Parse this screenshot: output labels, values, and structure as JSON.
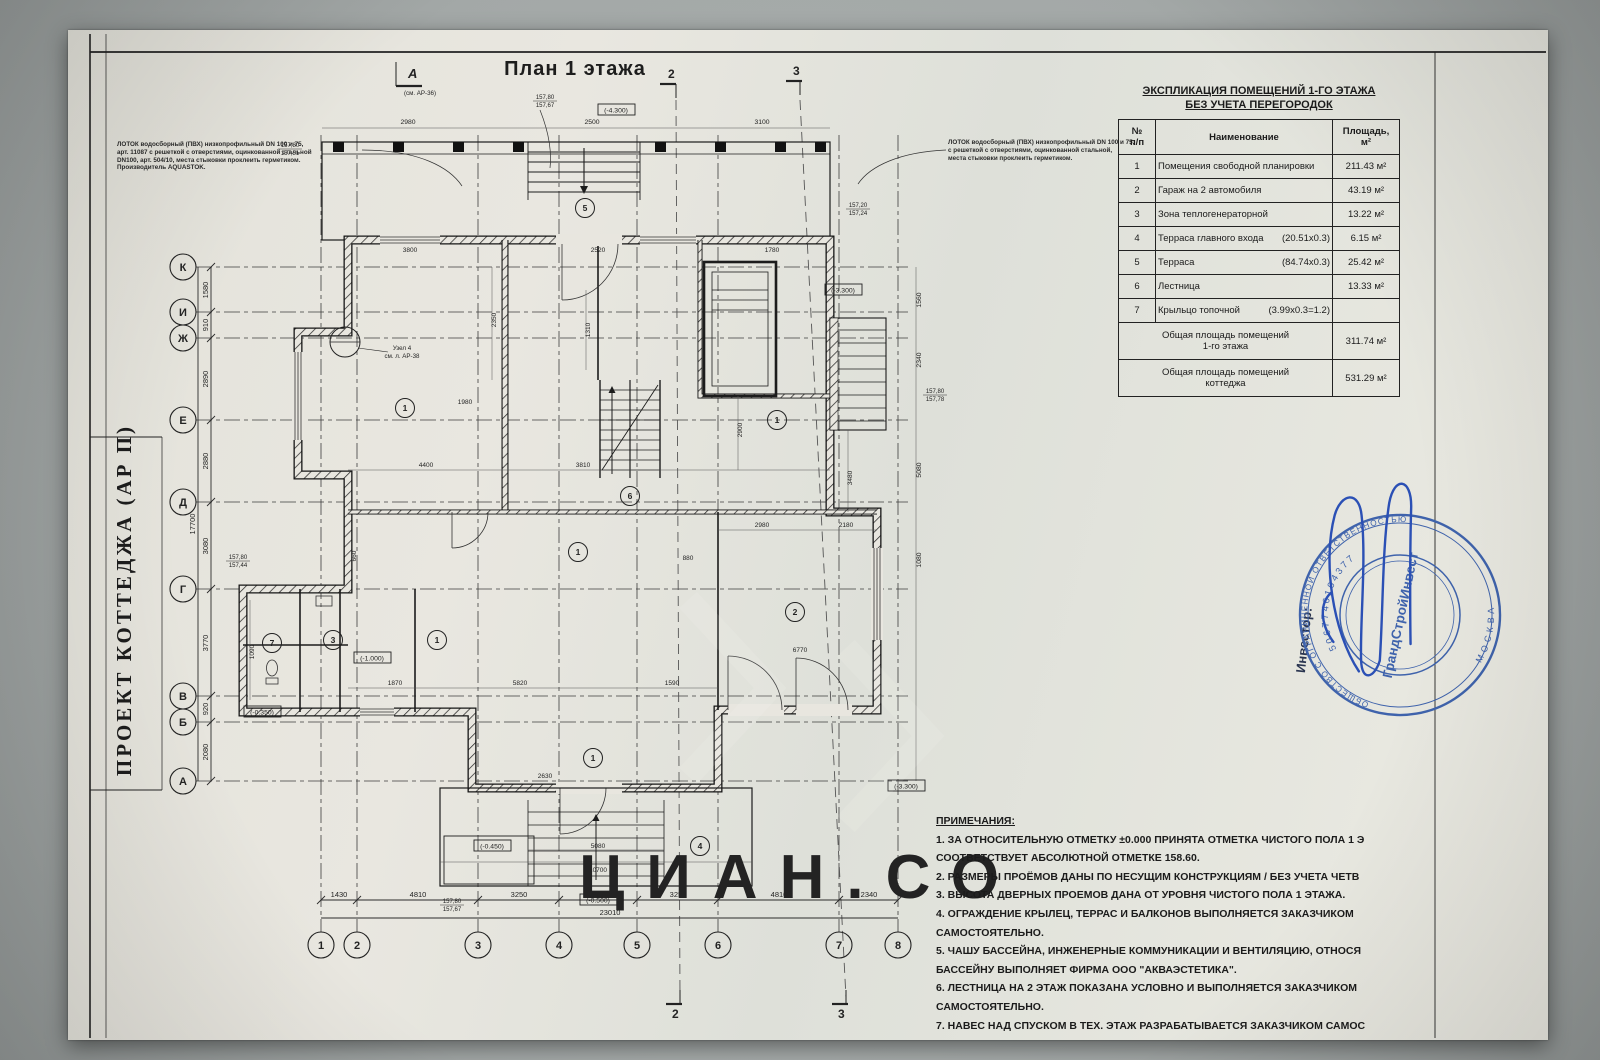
{
  "titles": {
    "plan_title": "План 1 этажа",
    "side_title": "ПРОЕКТ КОТТЕДЖА (АР П)"
  },
  "photo": {
    "watermark": "ЦИАН.СО"
  },
  "frame_markers": {
    "view_a": "А",
    "view_a_ref": "(см. АР-36)",
    "sec2": "2",
    "sec3": "3",
    "sec2b": "2",
    "sec3b": "3"
  },
  "lotok_left": [
    "ЛОТОК водосборный (ПВХ) низкопрофильный DN 100 и 75,",
    "арт. 11087 с решеткой с отверстиями, оцинкованной стальной",
    "DN100, арт. 504/10, места стыковки проклеить герметиком.",
    "Производитель AQUASTOK."
  ],
  "lotok_right": [
    "ЛОТОК водосборный (ПВХ) низкопрофильный DN 100 и 75,",
    "с решеткой с отверстиями, оцинкованной стальной,",
    "места стыковки проклеить герметиком."
  ],
  "explication": {
    "title_line1": "ЭКСПЛИКАЦИЯ ПОМЕЩЕНИЙ 1-ГО ЭТАЖА",
    "title_line2": "БЕЗ УЧЕТА ПЕРЕГОРОДОК",
    "col_num": "№\nп/п",
    "col_name": "Наименование",
    "col_area": "Площадь,\nм²",
    "rows": [
      {
        "num": "1",
        "name": "Помещения свободной планировки",
        "dims": "",
        "area": "211.43 м²"
      },
      {
        "num": "2",
        "name": "Гараж на 2 автомобиля",
        "dims": "",
        "area": "43.19 м²"
      },
      {
        "num": "3",
        "name": "Зона теплогенераторной",
        "dims": "",
        "area": "13.22 м²"
      },
      {
        "num": "4",
        "name": "Терраса главного входа",
        "dims": "(20.51х0.3)",
        "area": "6.15 м²"
      },
      {
        "num": "5",
        "name": "Терраса",
        "dims": "(84.74х0.3)",
        "area": "25.42 м²"
      },
      {
        "num": "6",
        "name": "Лестница",
        "dims": "",
        "area": "13.33 м²"
      },
      {
        "num": "7",
        "name": "Крыльцо топочной",
        "dims": "(3.99х0.3=1.2)",
        "area": ""
      }
    ],
    "total1_name": "Общая площадь помещений\n1-го этажа",
    "total1_area": "311.74 м²",
    "total2_name": "Общая площадь помещений\nкоттеджа",
    "total2_area": "531.29 м²"
  },
  "notes": {
    "heading": "ПРИМЕЧАНИЯ:",
    "lines": [
      "1. ЗА ОТНОСИТЕЛЬНУЮ ОТМЕТКУ ±0.000 ПРИНЯТА ОТМЕТКА ЧИСТОГО ПОЛА 1 Э",
      "СООТВЕТСТВУЕТ АБСОЛЮТНОЙ ОТМЕТКЕ 158.60.",
      "2. РАЗМЕРЫ ПРОЁМОВ ДАНЫ ПО НЕСУЩИМ КОНСТРУКЦИЯМ / БЕЗ УЧЕТА ЧЕТВ",
      "3. ВЫСОТА ДВЕРНЫХ ПРОЕМОВ ДАНА ОТ УРОВНЯ ЧИСТОГО ПОЛА 1 ЭТАЖА.",
      "4. ОГРАЖДЕНИЕ КРЫЛЕЦ, ТЕРРАС И БАЛКОНОВ ВЫПОЛНЯЕТСЯ ЗАКАЗЧИКОМ",
      "САМОСТОЯТЕЛЬНО.",
      "5. ЧАШУ БАССЕЙНА, ИНЖЕНЕРНЫЕ КОММУНИКАЦИИ И ВЕНТИЛЯЦИЮ, ОТНОСЯ",
      "БАССЕЙНУ ВЫПОЛНЯЕТ ФИРМА ООО \"АКВАЭСТЕТИКА\".",
      "6. ЛЕСТНИЦА НА 2 ЭТАЖ ПОКАЗАНА УСЛОВНО И ВЫПОЛНЯЕТСЯ ЗАКАЗЧИКОМ",
      "САМОСТОЯТЕЛЬНО.",
      "7. НАВЕС НАД СПУСКОМ В ТЕХ. ЭТАЖ РАЗРАБАТЫВАЕТСЯ ЗАКАЗЧИКОМ САМОС"
    ]
  },
  "plan": {
    "axes_left": [
      "К",
      "И",
      "Ж",
      "Е",
      "Д",
      "Г",
      "В",
      "Б",
      "А"
    ],
    "axes_bottom": [
      "1",
      "2",
      "3",
      "4",
      "5",
      "6",
      "7",
      "8"
    ],
    "dims_left": [
      "1580",
      "910",
      "2890",
      "2880",
      "3080",
      "3770",
      "920",
      "2080"
    ],
    "dims_left_total": "17700",
    "dims_bottom": [
      "1430",
      "4810",
      "3250",
      "3120",
      "3250",
      "4810",
      "2340"
    ],
    "dims_bottom_total": "23010",
    "dims_top": [
      "2980",
      "2500",
      "3100"
    ],
    "dims_right": [
      "1560",
      "2340",
      "5080",
      "1080"
    ],
    "dims_small": [
      "3800",
      "2520",
      "1780",
      "4400",
      "3810",
      "2980",
      "2180",
      "5820",
      "1870",
      "1590",
      "2630",
      "6770",
      "3480",
      "2350",
      "1090",
      "5080",
      "10700",
      "660",
      "1980",
      "2900",
      "1310",
      "880"
    ],
    "rooms": [
      "1",
      "5",
      "6",
      "1",
      "1",
      "2",
      "3",
      "7",
      "1",
      "1",
      "4"
    ],
    "levels": [
      "(-4.300)",
      "(-3.300)",
      "(-1.000)",
      "(-0.350)",
      "(-0.450)",
      "(-0.500)",
      "(-3.300)"
    ],
    "elev": [
      "157,80",
      "157,51",
      "157,80",
      "157,67",
      "157,20",
      "157,24",
      "157,80",
      "157,44",
      "157,80",
      "157,78",
      "157,80",
      "157,67"
    ],
    "detail_label1": "Узел 4",
    "detail_label2": "см. л. АР-38"
  },
  "stamp": {
    "investor_label": "Инвестор:",
    "ring_top": "ОБЩЕСТВО С ОГРАНИЧЕННОЙ ОТВЕТСТВЕННОСТЬЮ",
    "ring_bottom": "МОСКВА",
    "ogrn": "5067746104377",
    "center_name": "ГрандСтройИнвест"
  },
  "colors": {
    "stamp_blue": "#3f63ac",
    "signature_blue": "#2b50b5",
    "ink": "#232323",
    "paper": "#e8e6df",
    "photo_bg": "#a6abaa"
  }
}
